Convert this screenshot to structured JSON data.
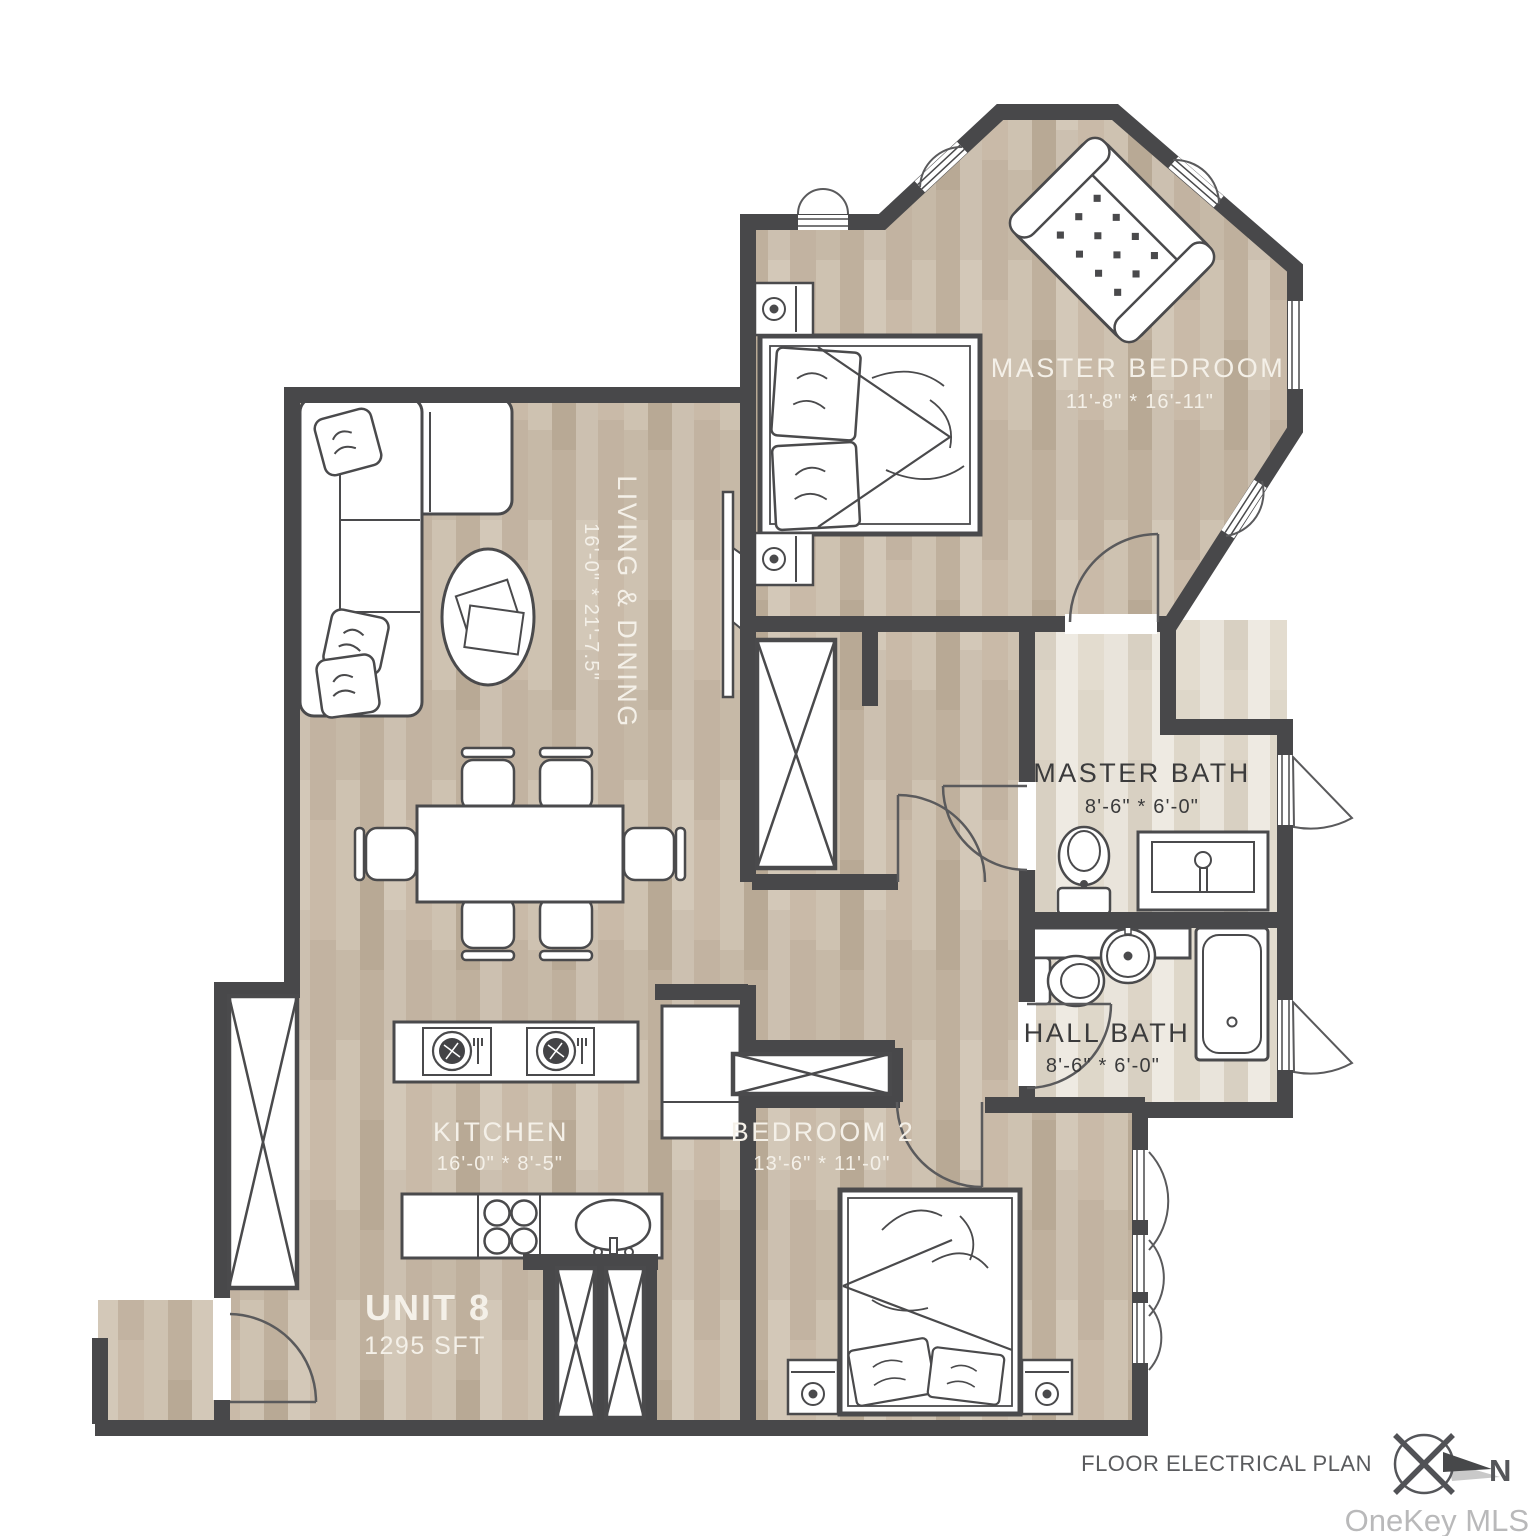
{
  "meta": {
    "caption": "FLOOR ELECTRICAL PLAN",
    "compass_label": "N",
    "watermark": "OneKey MLS"
  },
  "unit": {
    "name": "UNIT 8",
    "area": "1295 SFT"
  },
  "rooms": {
    "master_bedroom": {
      "name": "MASTER BEDROOM",
      "dims": "11'-8\" * 16'-11\""
    },
    "living_dining": {
      "name": "LIVING & DINING",
      "dims": "16'-0\" * 21'-7.5\""
    },
    "master_bath": {
      "name": "MASTER BATH",
      "dims": "8'-6\" * 6'-0\""
    },
    "hall_bath": {
      "name": "HALL BATH",
      "dims": "8'-6\" * 6'-0\""
    },
    "kitchen": {
      "name": "KITCHEN",
      "dims": "16'-0\" * 8'-5\""
    },
    "bedroom_2": {
      "name": "BEDROOM 2",
      "dims": "13'-6\" * 11'-0\""
    }
  },
  "colors": {
    "wall": "#48484a",
    "floor_wood": "#c9bcab",
    "floor_bath": "#e7e2d9",
    "label_light": "#f4f0e8",
    "label_dark": "#3b3b3c",
    "caption_gray": "#5a5b5e",
    "watermark_gray": "#b9b9ba"
  }
}
